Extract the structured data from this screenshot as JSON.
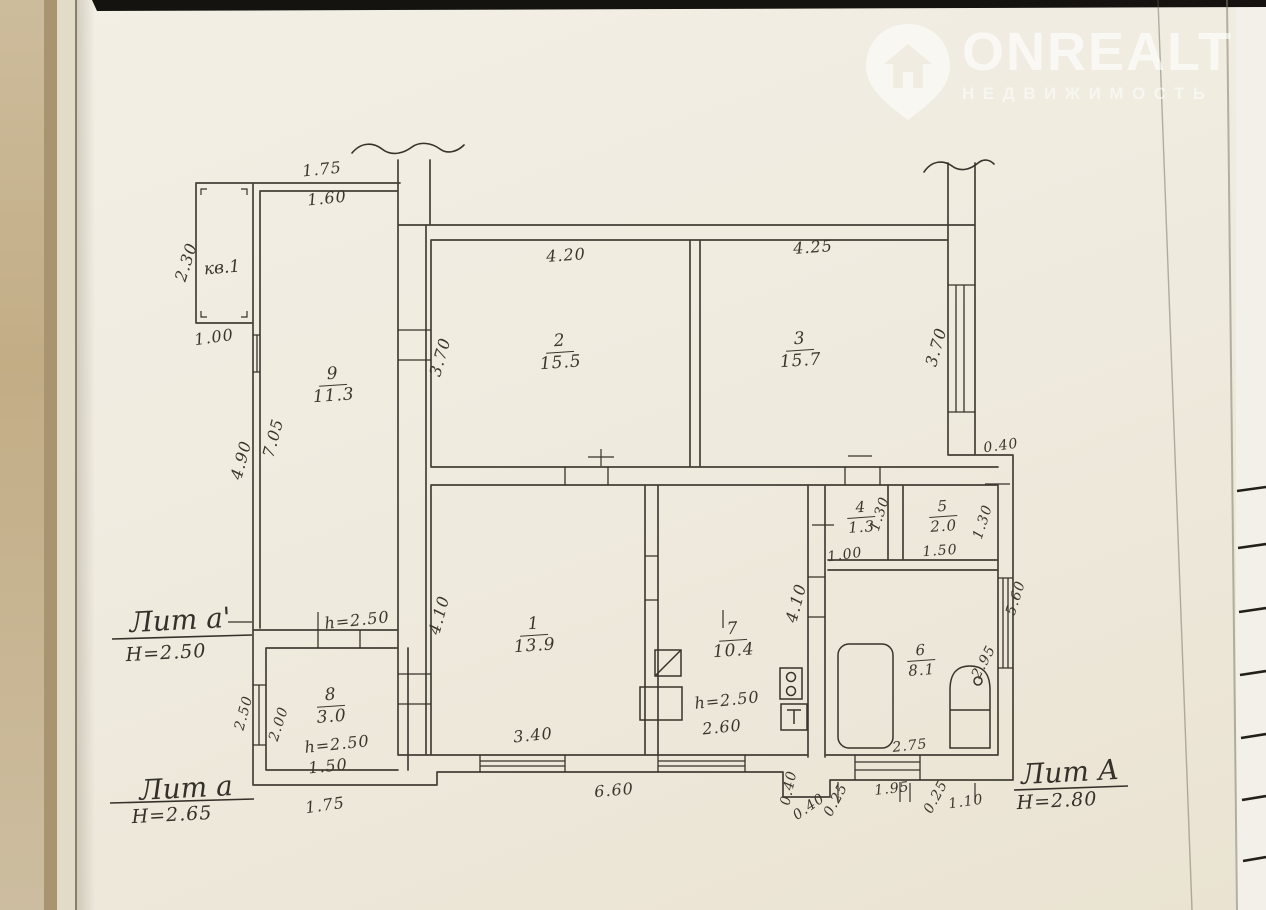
{
  "watermark": {
    "brand": "ONREALT",
    "subtitle": "НЕДВИЖИМОСТЬ"
  },
  "plan": {
    "apartment_label": "кв.1",
    "rooms": [
      {
        "num": "9",
        "area": "11.3"
      },
      {
        "num": "2",
        "area": "15.5"
      },
      {
        "num": "3",
        "area": "15.7"
      },
      {
        "num": "4",
        "area": "1.3"
      },
      {
        "num": "5",
        "area": "2.0"
      },
      {
        "num": "1",
        "area": "13.9"
      },
      {
        "num": "7",
        "area": "10.4"
      },
      {
        "num": "6",
        "area": "8.1"
      },
      {
        "num": "8",
        "area": "3.0"
      }
    ],
    "sections": [
      {
        "label": "Лит а'",
        "height": "Н=2.50"
      },
      {
        "label": "Лит а",
        "height": "Н=2.65"
      },
      {
        "label": "Лит А",
        "height": "Н=2.80"
      }
    ],
    "dims": {
      "porch_top": "1.75",
      "porch_width": "1.60",
      "porch_left": "2.30",
      "porch_bottom": "1.00",
      "hall_left_outer": "4.90",
      "hall_left_inner": "7.05",
      "hall_height": "h=2.50",
      "room2_top": "4.20",
      "room2_left": "3.70",
      "room3_top": "4.25",
      "room3_right": "3.70",
      "right_step": "0.40",
      "room4_height": "1.30",
      "room4_bottom": "1.00",
      "room5_bottom": "1.50",
      "room5_right": "1.30",
      "room1_left": "4.10",
      "room1_bottom": "3.40",
      "room7_right": "4.10",
      "room7_height": "h=2.50",
      "room7_bottom": "2.60",
      "room6_right": "2.95",
      "room6_bottom": "2.75",
      "right_wall_lower": "5.60",
      "room8_left_outer": "2.50",
      "room8_left_inner": "2.00",
      "room8_height": "h=2.50",
      "room8_bottom": "1.50",
      "annex_bottom": "1.75",
      "bottom_main": "6.60",
      "porch_step_depth": "0.40",
      "porch_step_width": "0.40",
      "bottom_tick_a": "0.25",
      "bottom_195": "1.95",
      "bottom_tick_b": "0.25",
      "bottom_110": "1.10"
    }
  }
}
